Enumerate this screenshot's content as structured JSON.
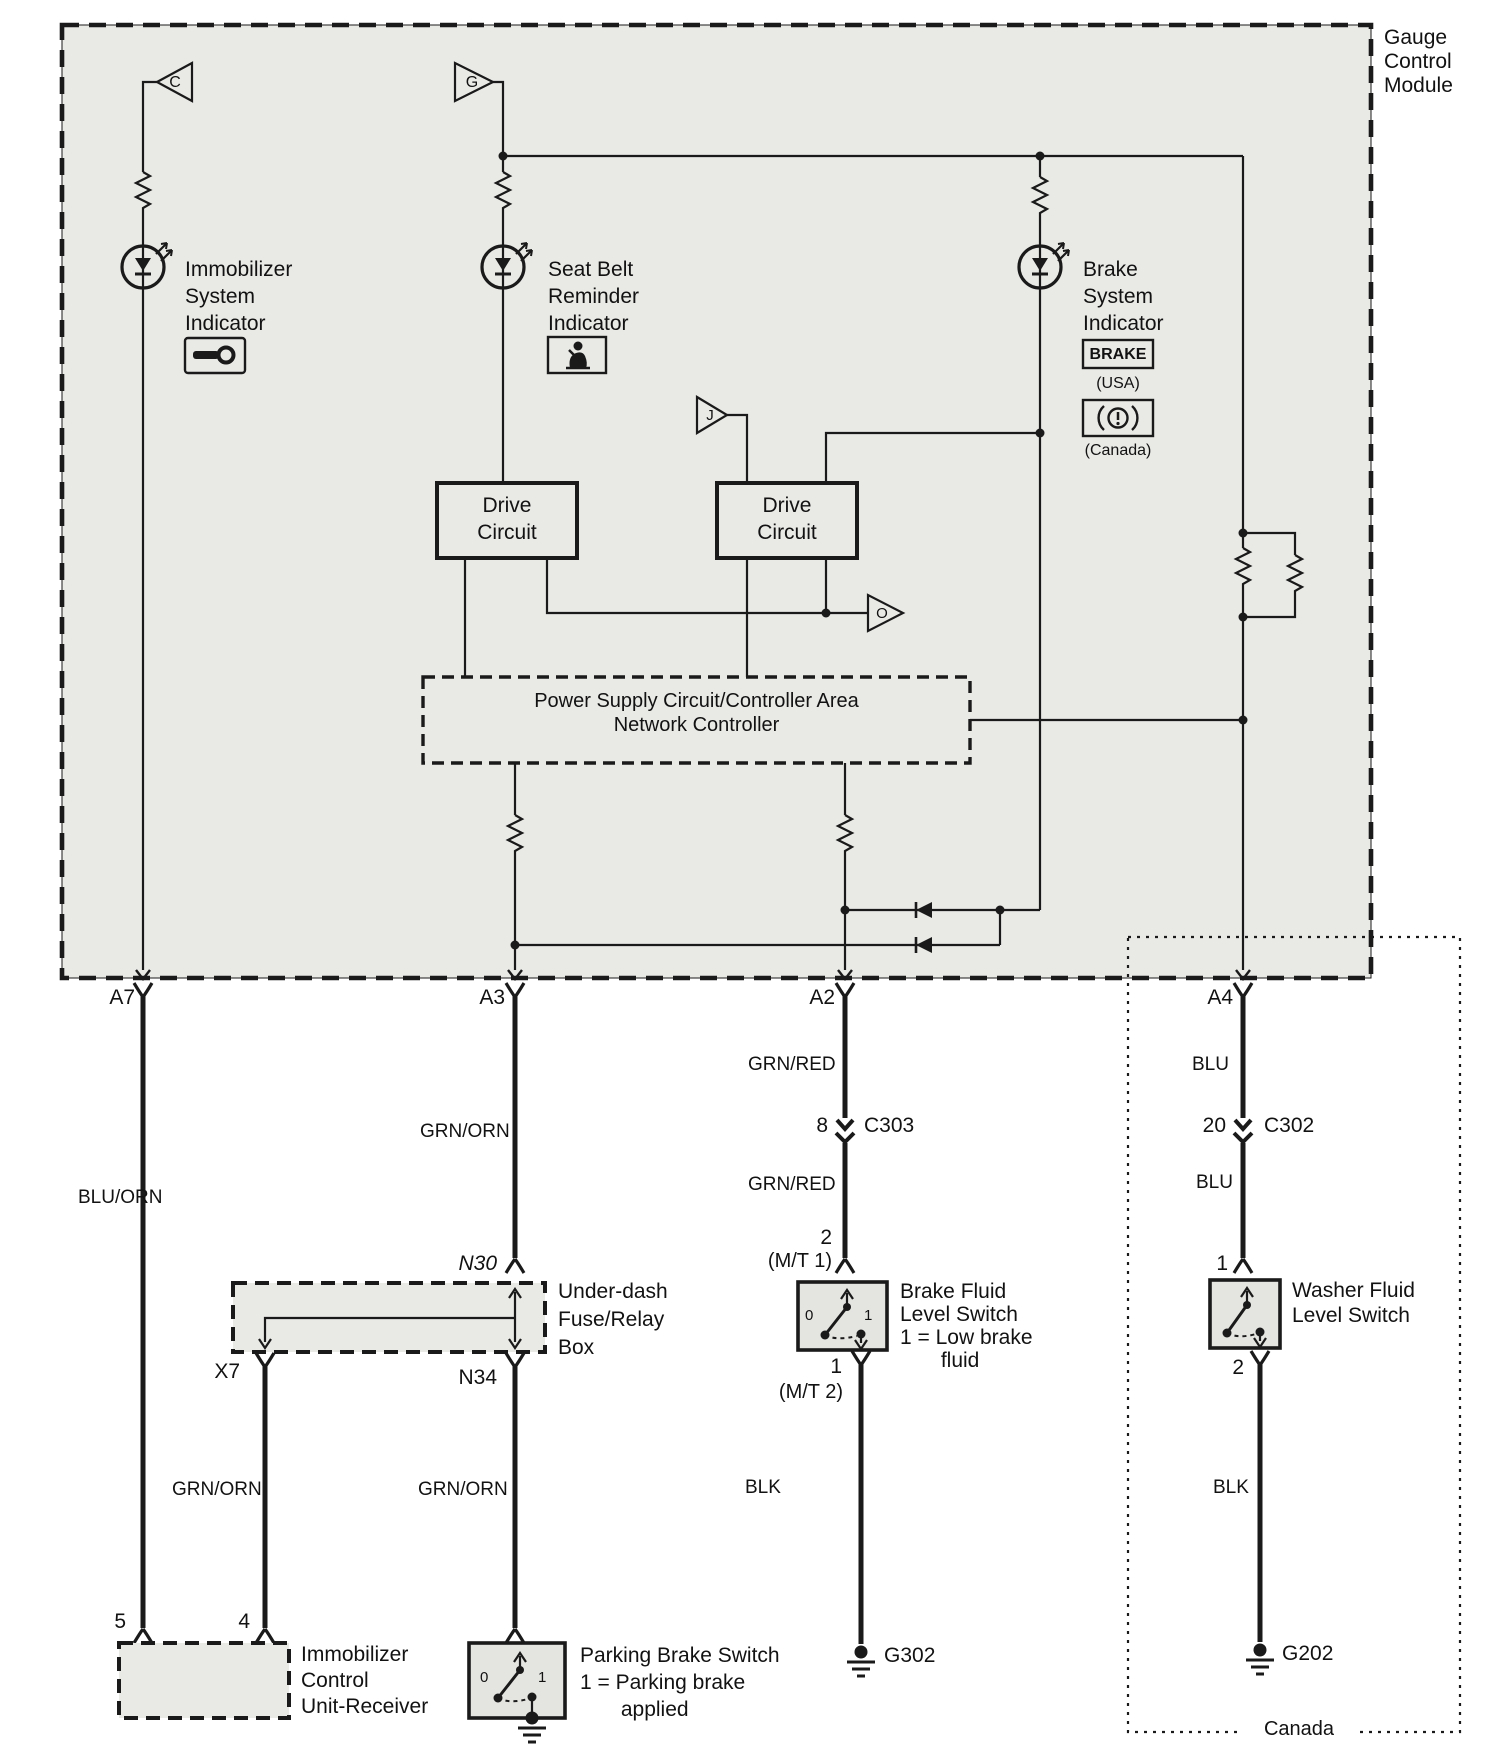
{
  "module": {
    "title": "Gauge\nControl\nModule"
  },
  "indicators": {
    "immobilizer": {
      "label": "Immobilizer\nSystem\nIndicator"
    },
    "seat_belt": {
      "label": "Seat Belt\nReminder\nIndicator"
    },
    "brake": {
      "label": "Brake\nSystem\nIndicator",
      "usa_icon_text": "BRAKE",
      "usa_caption": "(USA)",
      "canada_caption": "(Canada)"
    }
  },
  "triangles": {
    "c": "C",
    "g": "G",
    "j": "J",
    "o": "O"
  },
  "blocks": {
    "drive_circuit_1": "Drive\nCircuit",
    "drive_circuit_2": "Drive\nCircuit",
    "power_supply": "Power Supply Circuit/Controller Area\nNetwork Controller",
    "underdash": "Under-dash\nFuse/Relay\nBox",
    "immobilizer_receiver": "Immobilizer\nControl\nUnit-Receiver"
  },
  "pins": {
    "a7": "A7",
    "a3": "A3",
    "a2": "A2",
    "a4": "A4",
    "n30": "N30",
    "x7": "X7",
    "n34": "N34",
    "imm_5": "5",
    "imm_4": "4",
    "bfls_top": "2",
    "bfls_top_note": "(M/T 1)",
    "bfls_bottom": "1",
    "bfls_bottom_note": "(M/T 2)",
    "wfls_top": "1",
    "wfls_bottom": "2",
    "c303_pin": "8",
    "c303_name": "C303",
    "c302_pin": "20",
    "c302_name": "C302"
  },
  "wires": {
    "a7_color": "BLU/ORN",
    "a3_color": "GRN/ORN",
    "x7_color": "GRN/ORN",
    "n34_color": "GRN/ORN",
    "a2_color_upper": "GRN/RED",
    "a2_color_lower": "GRN/RED",
    "a4_color_upper": "BLU",
    "a4_color_lower": "BLU",
    "bfls_ground_color": "BLK",
    "wfls_ground_color": "BLK"
  },
  "switches": {
    "brake_fluid": {
      "label": "Brake Fluid\nLevel Switch\n1 = Low brake\n       fluid",
      "pos0": "0",
      "pos1": "1"
    },
    "parking": {
      "label": "Parking Brake Switch\n1 = Parking brake\n       applied",
      "pos0": "0",
      "pos1": "1"
    },
    "washer": {
      "label": "Washer Fluid\nLevel Switch"
    }
  },
  "grounds": {
    "g302": "G302",
    "g202": "G202"
  },
  "region": {
    "canada": "Canada"
  }
}
